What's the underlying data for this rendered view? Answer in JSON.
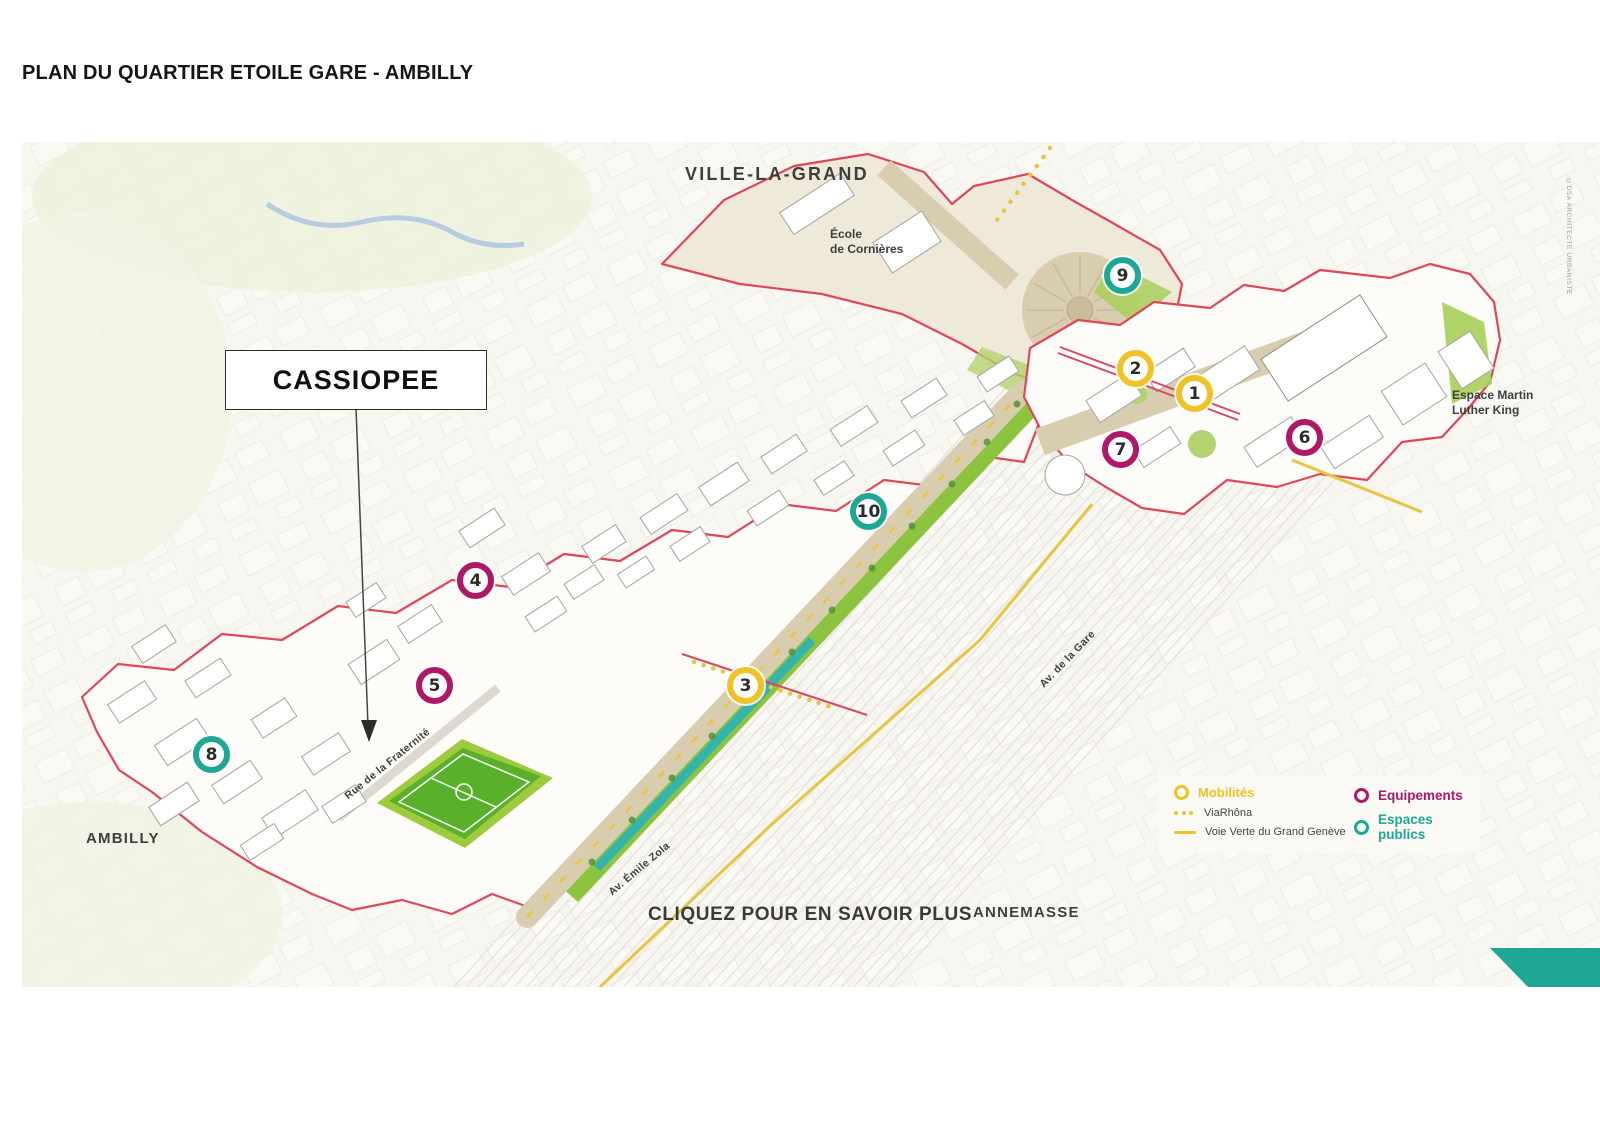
{
  "page": {
    "title": "PLAN DU QUARTIER ETOILE GARE - AMBILLY"
  },
  "map": {
    "area_labels": {
      "ville_la_grand": "VILLE-LA-GRAND",
      "ambilly": "AMBILLY",
      "annemasse": "ANNEMASSE"
    },
    "place_labels": {
      "ecole_line1": "École",
      "ecole_line2": "de Cornières",
      "mlk_line1": "Espace Martin",
      "mlk_line2": "Luther King"
    },
    "street_labels": {
      "fraternite": "Rue de la Fraternité",
      "emile_zola": "Av. Émile Zola",
      "gare": "Av. de la Gare"
    },
    "cta": "CLIQUEZ POUR EN SAVOIR PLUS",
    "callout": {
      "label": "CASSIOPEE"
    },
    "credit": "©DSA ARCHITECTE URBANISTE",
    "markers": [
      {
        "number": "1",
        "category": "mobilites"
      },
      {
        "number": "2",
        "category": "mobilites"
      },
      {
        "number": "3",
        "category": "mobilites"
      },
      {
        "number": "4",
        "category": "equipements"
      },
      {
        "number": "5",
        "category": "equipements"
      },
      {
        "number": "6",
        "category": "equipements"
      },
      {
        "number": "7",
        "category": "equipements"
      },
      {
        "number": "8",
        "category": "espaces_publics"
      },
      {
        "number": "9",
        "category": "espaces_publics"
      },
      {
        "number": "10",
        "category": "espaces_publics"
      }
    ],
    "legend": {
      "mobilites": "Mobilités",
      "viarhona": "ViaRhôna",
      "voie_verte": "Voie Verte du Grand Genève",
      "equipements": "Equipements",
      "espaces_publics": "Espaces publics"
    },
    "colors": {
      "mobilites": "#EFC225",
      "equipements": "#AF1767",
      "espaces_publics": "#1EA795",
      "boundary": "#E0465A",
      "corner_accent": "#1EA795"
    }
  }
}
